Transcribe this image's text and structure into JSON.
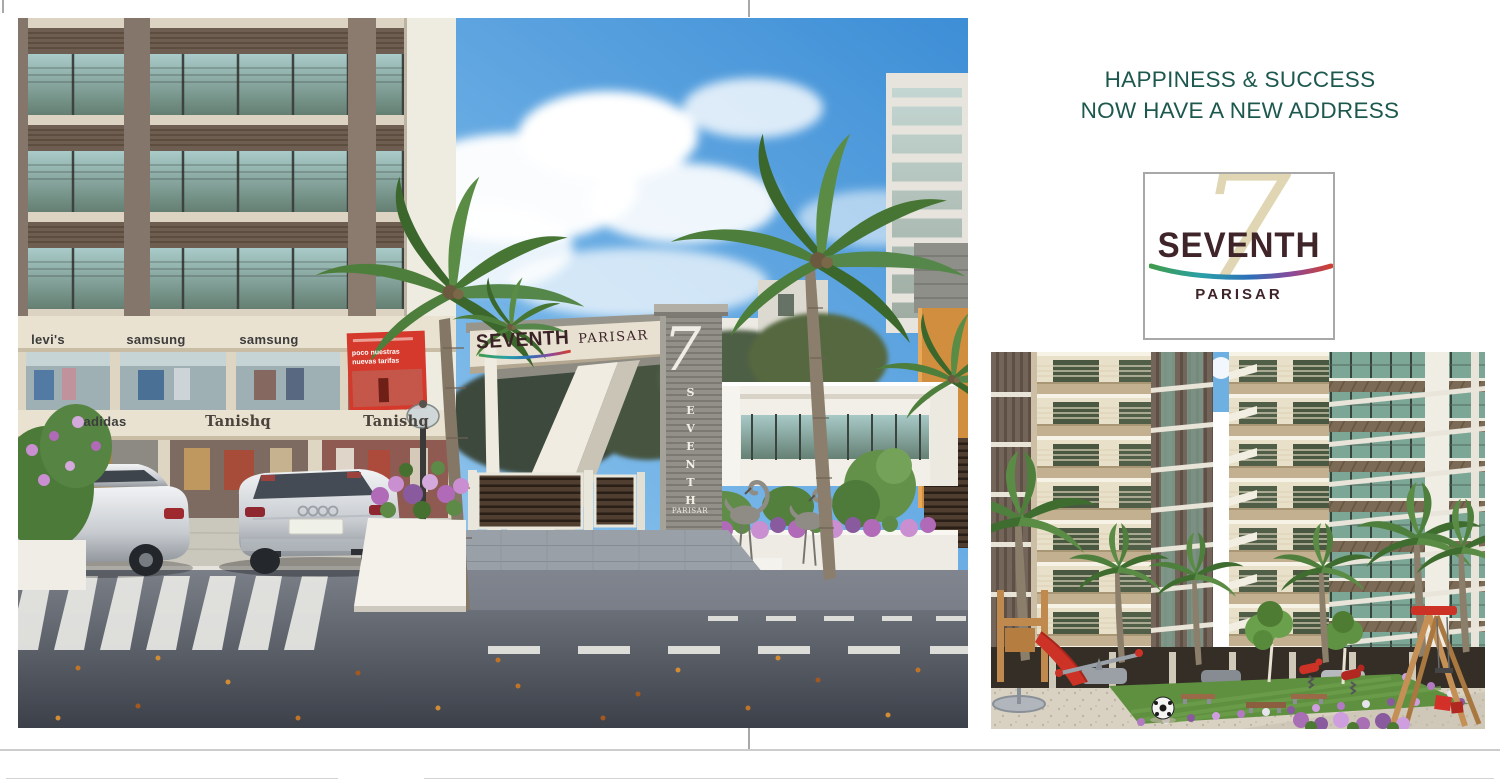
{
  "headline": {
    "line1": "HAPPINESS & SUCCESS",
    "line2": "NOW HAVE A NEW ADDRESS",
    "color": "#1d584e"
  },
  "logo": {
    "numeral": "7",
    "name": "SEVENTH",
    "subtitle": "PARISAR",
    "name_color": "#3f2429",
    "numeral_color": "#dbd0a6",
    "swoosh_colors": [
      "#3f9b4a",
      "#2aa0a8",
      "#2e6fb8",
      "#8a4a9b",
      "#d04030"
    ]
  },
  "left_render": {
    "gate_sign_primary": "SEVENTH",
    "gate_sign_secondary": "PARISAR",
    "pillar_numeral": "7",
    "pillar_vertical_text": "SEVENTH",
    "pillar_base_text": "PARISAR",
    "shop_signs_upper": [
      "levi's",
      "samsung",
      "samsung"
    ],
    "shop_signs_lower": [
      "adidas",
      "Tanishq",
      "Tanishq"
    ],
    "billboard": {
      "line1": "poco nuestras",
      "line2": "nuevas tarifas",
      "color": "#d5392c"
    }
  }
}
